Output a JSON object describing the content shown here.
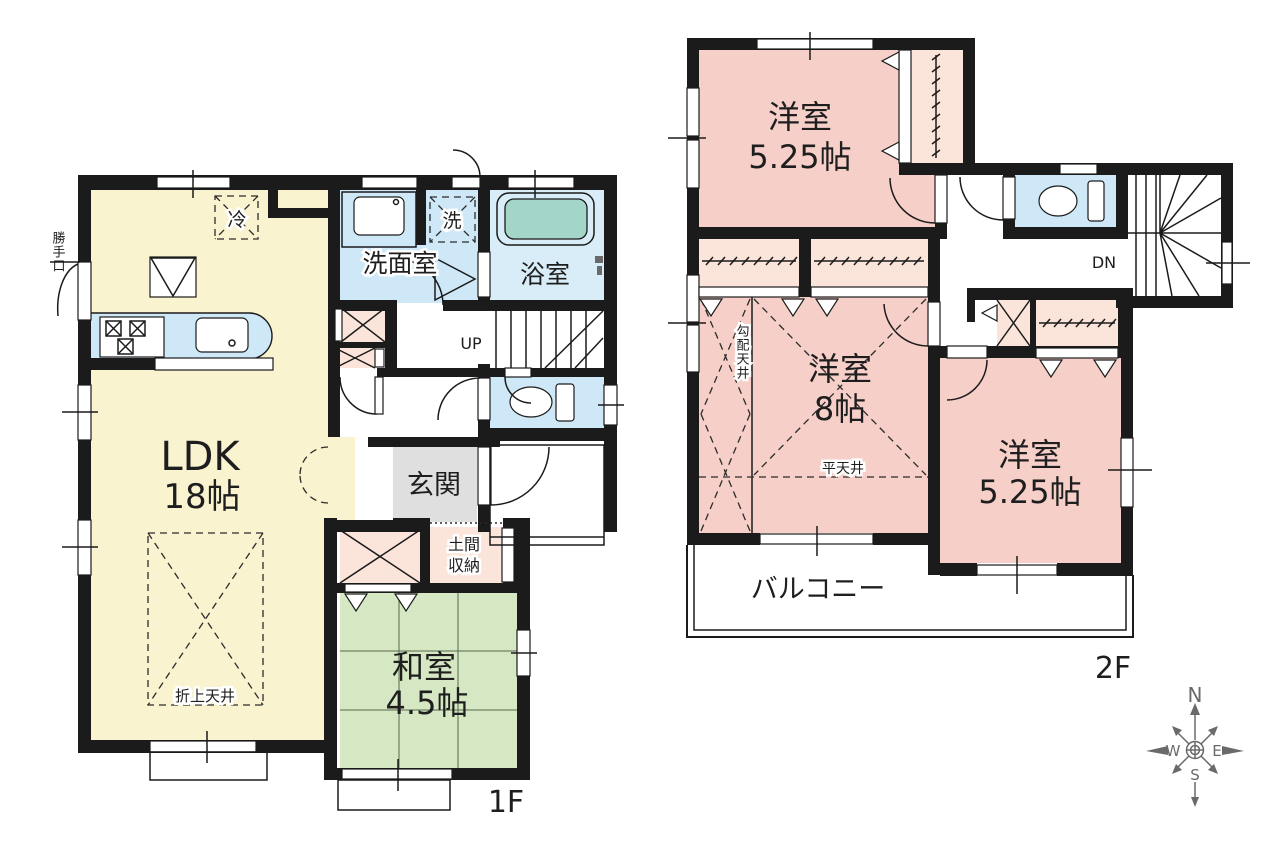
{
  "floor1": {
    "label": "1F",
    "ldk_name": "LDK",
    "ldk_size": "18帖",
    "washitsu_name": "和室",
    "washitsu_size": "4.5帖",
    "washroom": "洗面室",
    "bathroom": "浴室",
    "entrance": "玄関",
    "doma_line1": "土間",
    "doma_line2": "収納",
    "fridge": "冷",
    "washer": "洗",
    "backdoor": "勝手口",
    "stairs_up": "UP",
    "folded_ceiling": "折上天井"
  },
  "floor2": {
    "label": "2F",
    "bedroom1_name": "洋室",
    "bedroom1_size": "5.25帖",
    "bedroom2_name": "洋室",
    "bedroom2_size": "8帖",
    "bedroom3_name": "洋室",
    "bedroom3_size": "5.25帖",
    "balcony": "バルコニー",
    "stairs_down": "DN",
    "sloped_ceiling": "勾配天井",
    "flat_ceiling": "平天井"
  },
  "compass": {
    "north": "N",
    "east": "E",
    "south": "S",
    "west": "W"
  },
  "colors": {
    "wall": "#1b1b1b",
    "ldk_floor": "#faf3cf",
    "tatami_floor": "#d6e7c4",
    "water_area": "#cfe8f7",
    "bath_floor": "#d9edf8",
    "bathtub": "#a3d5c9",
    "bedroom_floor": "#f6cfc9",
    "closet": "#fbe5da",
    "entrance_floor": "#dfdfdf",
    "compass": "#6a6a6a"
  }
}
